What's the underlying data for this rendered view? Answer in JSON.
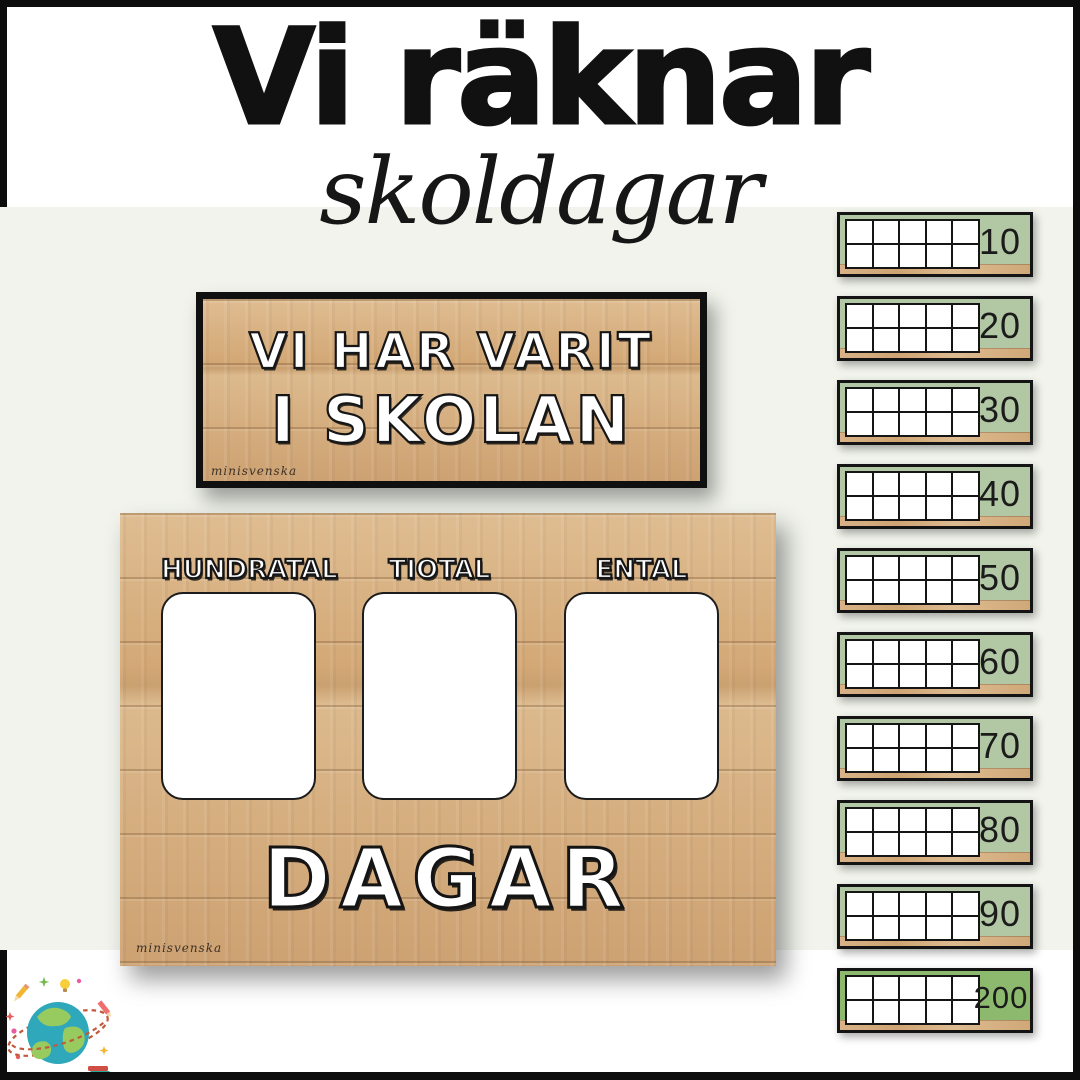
{
  "header": {
    "title": "Vi räknar",
    "subtitle": "skoldagar"
  },
  "sign": {
    "line1": "VI HAR VARIT",
    "line2": "I SKOLAN",
    "watermark": "minisvenska"
  },
  "board": {
    "column_labels": [
      "HUNDRATAL",
      "TIOTAL",
      "ENTAL"
    ],
    "caption": "DAGAR",
    "watermark": "minisvenska"
  },
  "ten_frames": {
    "grid": {
      "rows": 2,
      "cols": 5
    },
    "cards": [
      {
        "value": "10"
      },
      {
        "value": "20"
      },
      {
        "value": "30"
      },
      {
        "value": "40"
      },
      {
        "value": "50"
      },
      {
        "value": "60"
      },
      {
        "value": "70"
      },
      {
        "value": "80"
      },
      {
        "value": "90"
      },
      {
        "value": "200",
        "highlight": true
      }
    ]
  },
  "icons": {
    "globe": "globe-with-school-doodles"
  },
  "colors": {
    "band_background": "#f1f3ec",
    "card_green": "#b2c8a5",
    "card_green_highlight": "#8db96f",
    "wood": "#d5ad7e",
    "frame_black": "#0d0d0d"
  }
}
